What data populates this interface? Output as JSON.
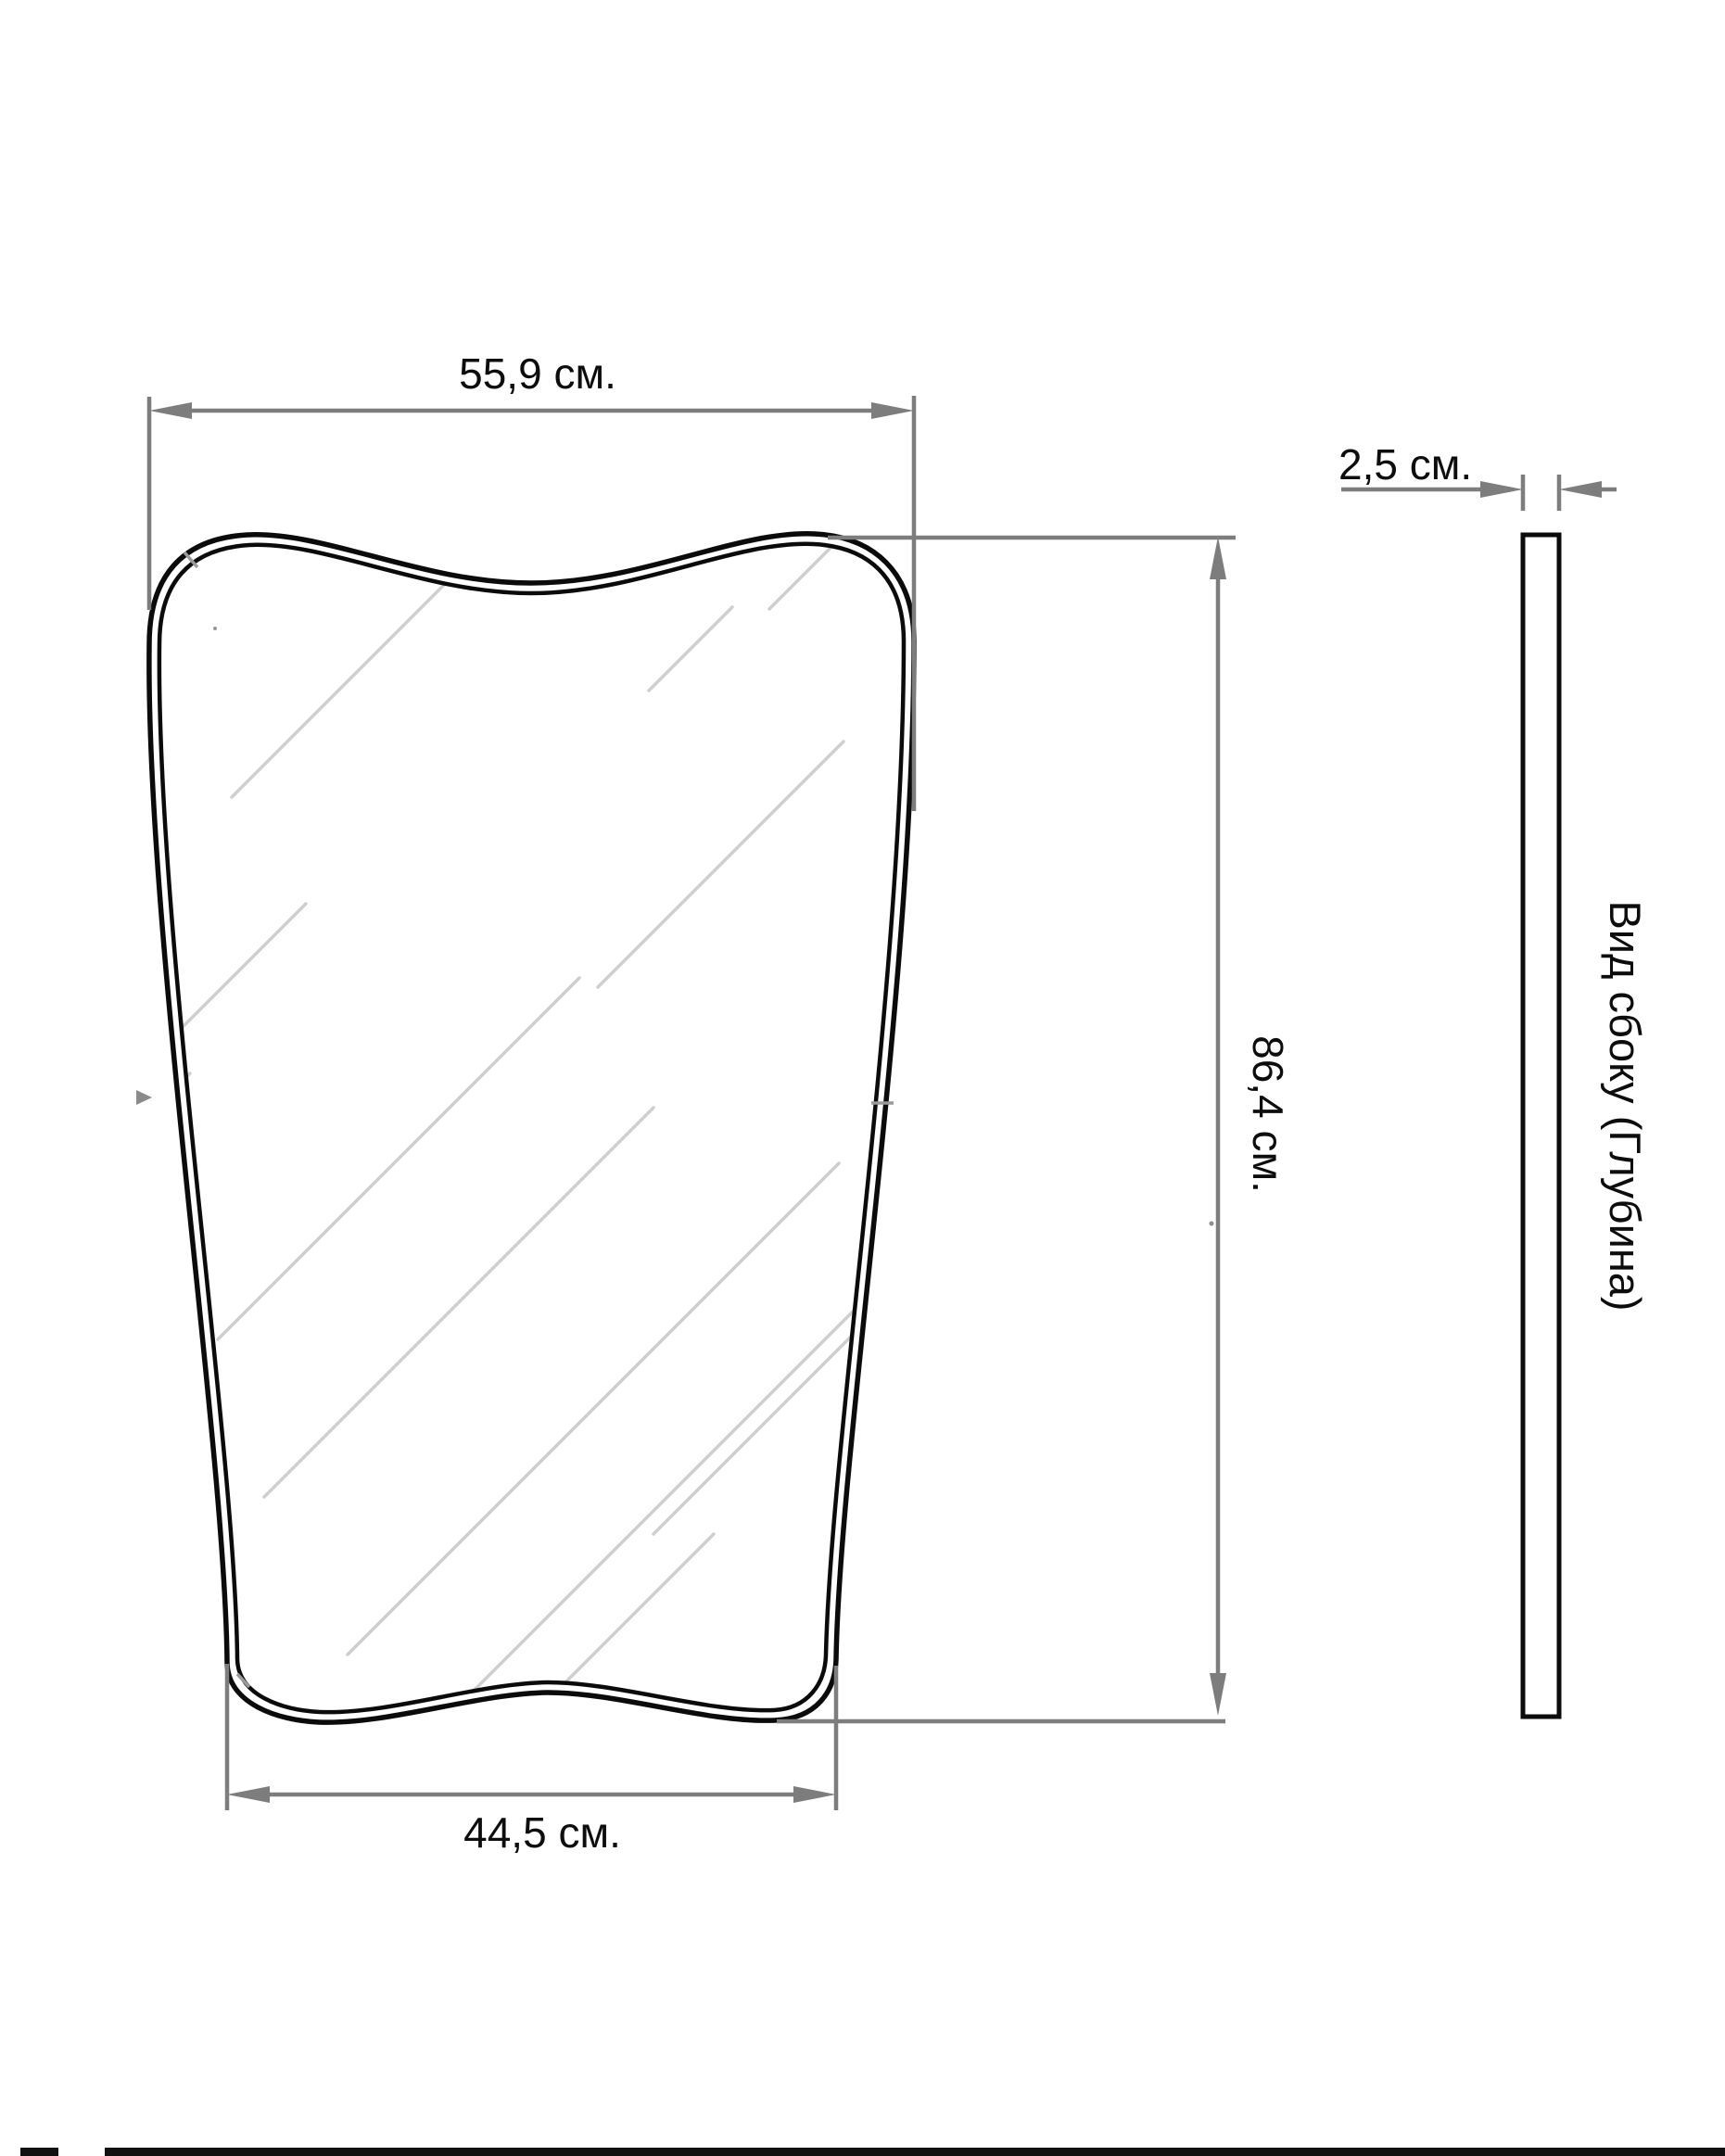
{
  "drawing": {
    "front_view": {
      "top_width_label": "55,9 см.",
      "bottom_width_label": "44,5 см.",
      "height_label": "86,4 см."
    },
    "side_view": {
      "depth_label": "2,5 см.",
      "caption": "Вид сбоку (Глубина)"
    }
  },
  "colors": {
    "outline": "#0b0b0b",
    "dimension_gray": "#7d7d7d",
    "hatch_gray": "#cfcfcf",
    "background": "#ffffff"
  }
}
